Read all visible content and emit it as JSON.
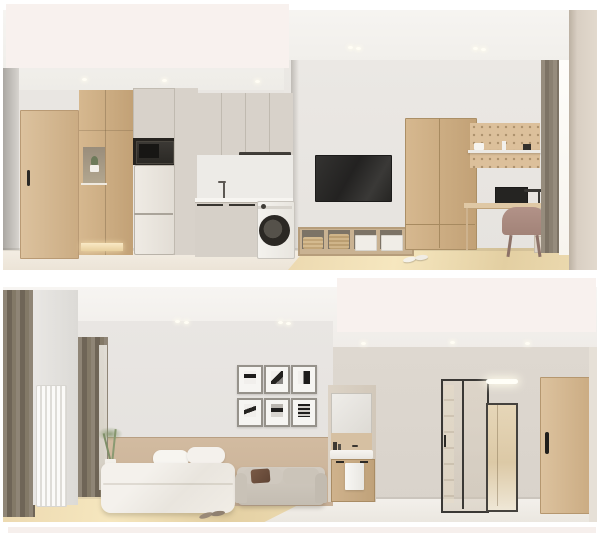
{
  "page": {
    "title": "Apartment interior renderings — two stacked views",
    "background": "#ffffff"
  },
  "overlays": {
    "top_left_block": {
      "color": "#f8f1ee",
      "shape": "rectangle"
    },
    "bottom_right_block": {
      "color": "#f8f1ee",
      "shape": "rectangle"
    },
    "bottom_band": {
      "color": "#f6efec",
      "shape": "strip"
    }
  },
  "palette": {
    "wall_gray": "#e8e5e1",
    "wall_greige": "#dcd6ce",
    "ceiling": "#f2f0ec",
    "wood_light": "#d8bd99",
    "wood_medium": "#c9ab82",
    "cabinet_cream": "#d8d2ca",
    "wainscot_tan": "#cdb69c",
    "curtain_taupe": "#837967",
    "tv_dark": "#2e2d2b",
    "floor_wood": "#e9d6ad",
    "floor_tile": "#f0e9df",
    "accent_glow": "#f7e7c8"
  },
  "scenes": {
    "top": {
      "label": "Studio view 1: entry door, shoe cabinet, microwave, fridge, kitchen with range hood and sink, washing machine, wall TV, storage baskets, wardrobe, pegboard desk nook with monitor, lamp and chair, curtained window",
      "objects": [
        "entry-door",
        "shoe-cabinet",
        "plant-niche",
        "microwave",
        "fridge",
        "kitchen-upper-cabinets",
        "range-hood",
        "sink-faucet",
        "base-cabinets",
        "washing-machine",
        "tv",
        "basket-shelf",
        "wardrobe",
        "pegboard",
        "wall-shelf",
        "monitor",
        "desk-lamp",
        "desk",
        "desk-chair",
        "curtain",
        "window",
        "slippers"
      ]
    },
    "bottom": {
      "label": "Studio view 2: bedroom with curtains, radiator, plant, nightstand, bed, six framed prints, sofa, bathroom vanity with mirror cabinet and towel, sliding glass door, wall light, full mirror, entry door",
      "objects": [
        "curtains",
        "radiator",
        "window-curtain",
        "plant",
        "nightstand",
        "bed",
        "gallery-frames",
        "sofa",
        "mirror-cabinet",
        "vanity-sink",
        "towel",
        "vanity-cabinet",
        "sliding-glass-door",
        "led-wall-light",
        "floor-mirror",
        "entry-door",
        "slippers"
      ]
    }
  }
}
